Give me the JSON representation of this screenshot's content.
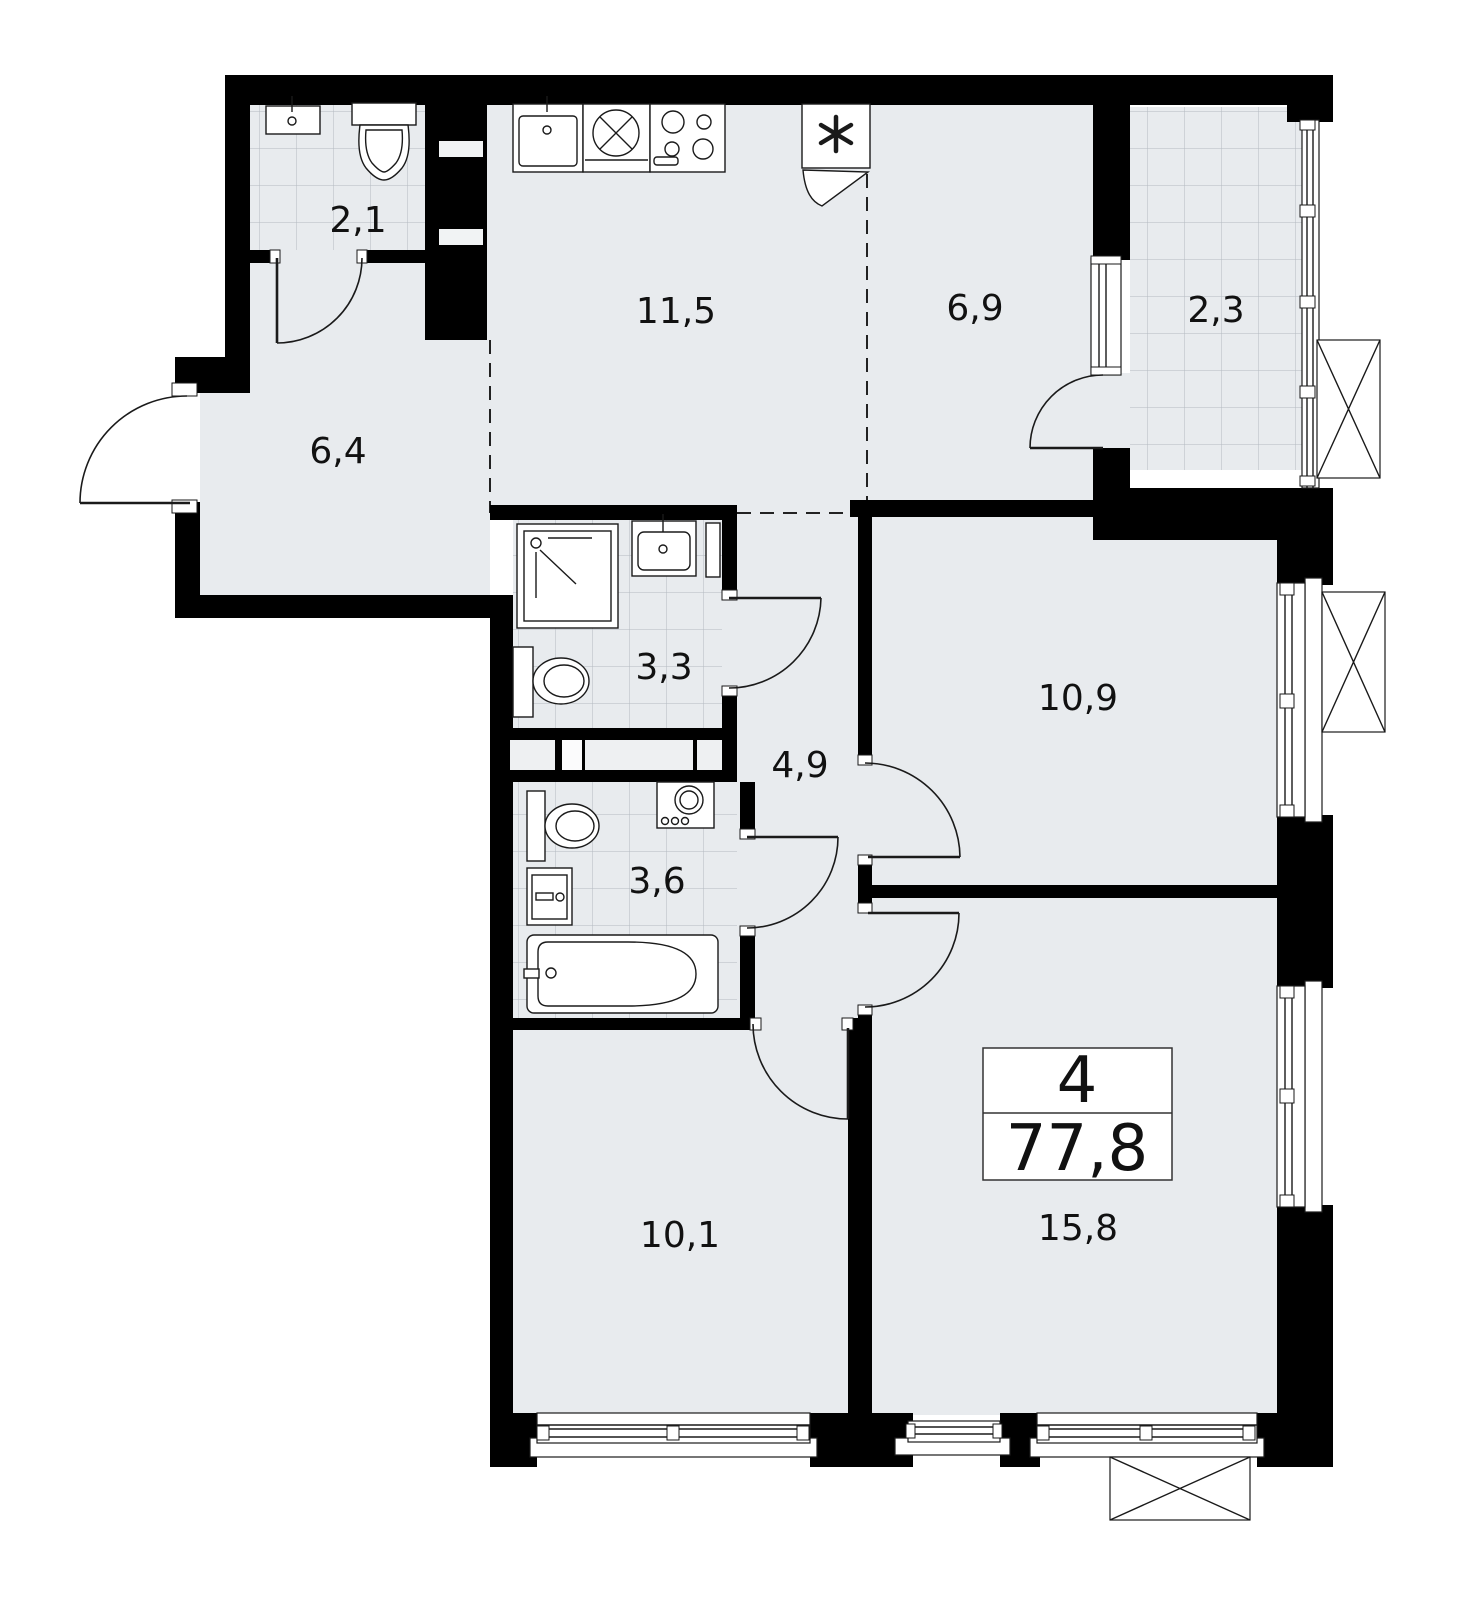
{
  "plan": {
    "title": "Apartment floor plan",
    "summary": {
      "rooms_count": "4",
      "total_area": "77,8"
    },
    "rooms": {
      "bathroom_small": {
        "label": "2,1",
        "type": "wc"
      },
      "kitchen": {
        "label": "11,5",
        "type": "kitchen"
      },
      "room_69": {
        "label": "6,9",
        "type": "room"
      },
      "balcony": {
        "label": "2,3",
        "type": "balcony"
      },
      "hallway": {
        "label": "6,4",
        "type": "hallway"
      },
      "shower_room": {
        "label": "3,3",
        "type": "shower-room"
      },
      "corridor": {
        "label": "4,9",
        "type": "corridor"
      },
      "bathroom_big": {
        "label": "3,6",
        "type": "bathroom"
      },
      "bedroom_1": {
        "label": "10,9",
        "type": "room"
      },
      "bedroom_2": {
        "label": "10,1",
        "type": "room"
      },
      "living_room": {
        "label": "15,8",
        "type": "room"
      }
    },
    "symbols": [
      "sink-icon",
      "toilet-icon",
      "shower-icon",
      "washing-machine-icon",
      "stove-icon",
      "fridge-icon",
      "bathtub-icon",
      "air-conditioner-icon",
      "window",
      "door-swing",
      "vent-shaft"
    ],
    "colors": {
      "wall": "#000000",
      "floor": "#e8ebee",
      "tile_line": "#b3bac0",
      "line": "#1a1a1a",
      "background": "#ffffff"
    }
  }
}
